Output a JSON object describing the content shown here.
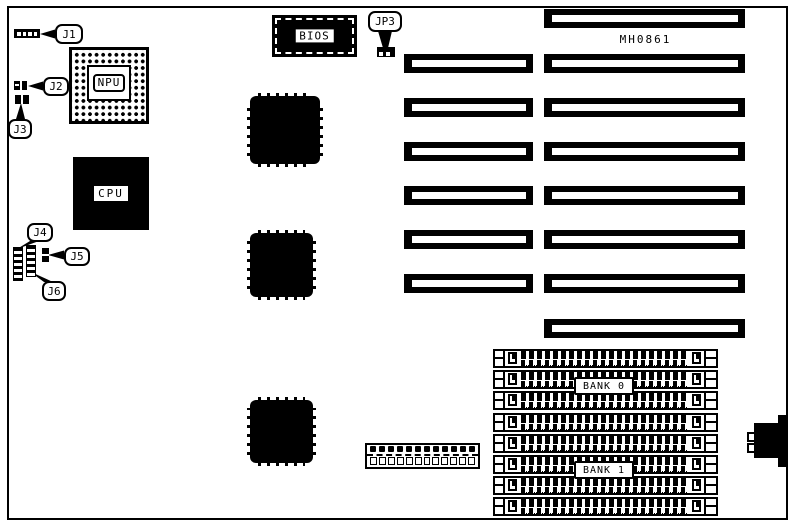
{
  "board": {
    "model_label": "MH0861",
    "chips": {
      "bios": "BIOS",
      "npu": "NPU",
      "cpu": "CPU"
    },
    "memory_banks": {
      "bank0": "BANK 0",
      "bank1": "BANK 1"
    },
    "jumpers": {
      "j1": "J1",
      "j2": "J2",
      "j3": "J3",
      "j4": "J4",
      "j5": "J5",
      "j6": "J6",
      "jp3": "JP3"
    },
    "counts": {
      "expansion_slots_left": 6,
      "expansion_slots_right": 8,
      "simm_sockets": 8,
      "qfp_chips": 3,
      "bottom_connector_pins": 12
    }
  }
}
